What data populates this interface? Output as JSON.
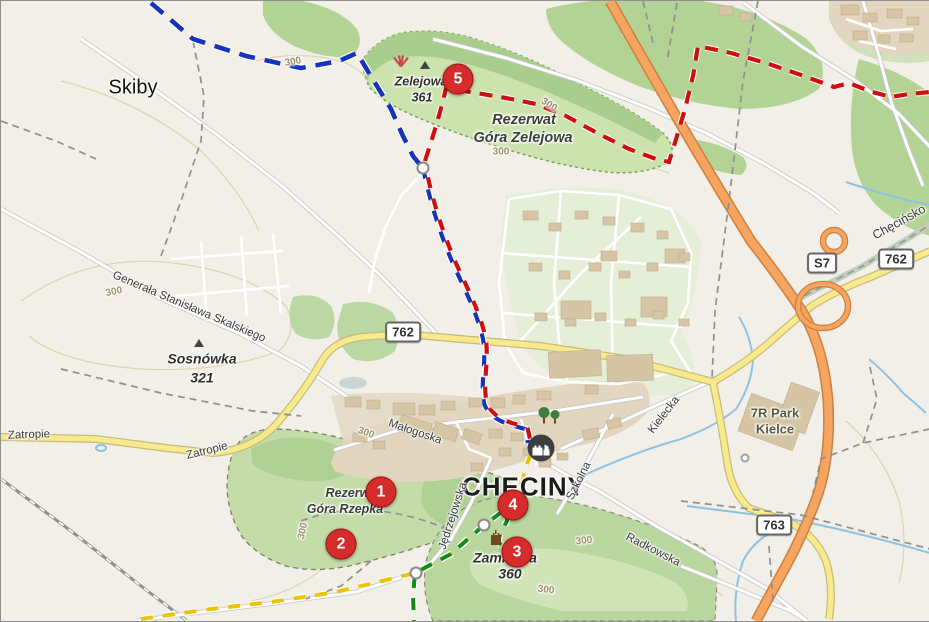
{
  "map": {
    "city": "CHĘCINY",
    "village": "Skiby",
    "peaks": {
      "zelejowa": {
        "name": "Zelejowa",
        "elev": "361"
      },
      "sosnowka": {
        "name": "Sosnówka",
        "elev": "321"
      },
      "zamkowa": {
        "name": "Zamkowa",
        "elev": "360"
      }
    },
    "reserves": {
      "zelejowa_l1": "Rezerwat",
      "zelejowa_l2": "Góra Zelejowa",
      "rzepka_l1": "Rezerwat",
      "rzepka_l2": "Góra Rzepka"
    },
    "streets": {
      "skalskiego": "Generała Stanisława Skalskiego",
      "malogoska": "Małogoska",
      "kielecka": "Kielecka",
      "szkolna": "Szkolna",
      "jedrzejowska": "Jędrzejowska",
      "radkowska": "Radkowska",
      "checinsko": "Chęcińsko",
      "zatropie": "Zatropie"
    },
    "pois": {
      "park7r_l1": "7R Park",
      "park7r_l2": "Kielce"
    },
    "road_refs": {
      "s7": "S7",
      "r762": "762",
      "r763": "763"
    },
    "contour_label": "300",
    "markers": [
      {
        "n": "1"
      },
      {
        "n": "2"
      },
      {
        "n": "3"
      },
      {
        "n": "4"
      },
      {
        "n": "5"
      }
    ],
    "trail_colors": {
      "red": "#cf0e0e",
      "blue": "#1633bb",
      "green": "#168a16",
      "yellow": "#e9c400"
    },
    "road_colors": {
      "trunk": "#f5a55f",
      "secondary": "#f7e98c"
    },
    "landuse_colors": {
      "forest": "#b3d395",
      "reserve_grass": "#cde3ae",
      "town": "#e2d6c0",
      "residential": "#e5eed7"
    }
  }
}
